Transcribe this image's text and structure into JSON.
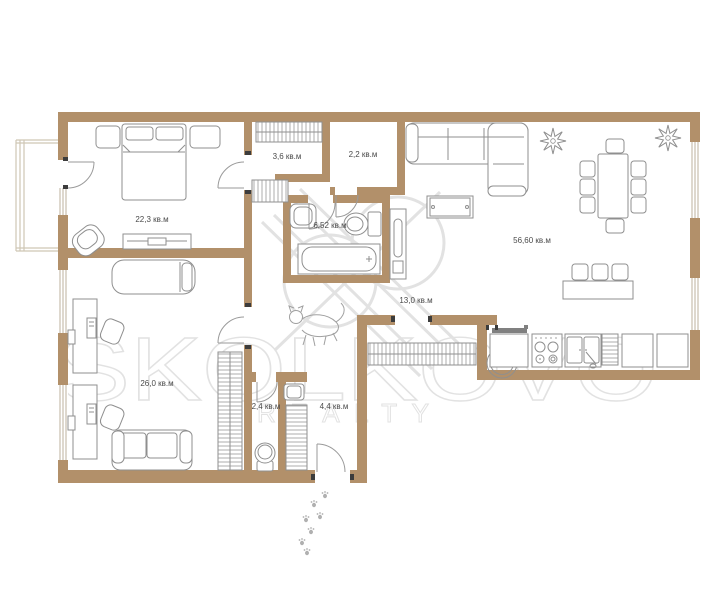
{
  "watermark": {
    "brand": "SKOLKOVO",
    "sub": "REALTY"
  },
  "rooms": [
    {
      "id": "bedroom",
      "label": "22,3 кв.м"
    },
    {
      "id": "wardrobe-1",
      "label": "3,6 кв.м"
    },
    {
      "id": "wardrobe-2",
      "label": "2,2 кв.м"
    },
    {
      "id": "bathroom",
      "label": "6,52 кв.м"
    },
    {
      "id": "living-room",
      "label": "56,60 кв.м"
    },
    {
      "id": "hallway",
      "label": "13,0 кв.м"
    },
    {
      "id": "study",
      "label": "26,0 кв.м"
    },
    {
      "id": "wc",
      "label": "2,4 кв.м"
    },
    {
      "id": "entry",
      "label": "4,4 кв.м"
    }
  ],
  "colors": {
    "wall": "#b2906a",
    "furniture_outline": "#8f8f8f",
    "watermark": "#e2e2e2",
    "paper": "#ffffff"
  }
}
